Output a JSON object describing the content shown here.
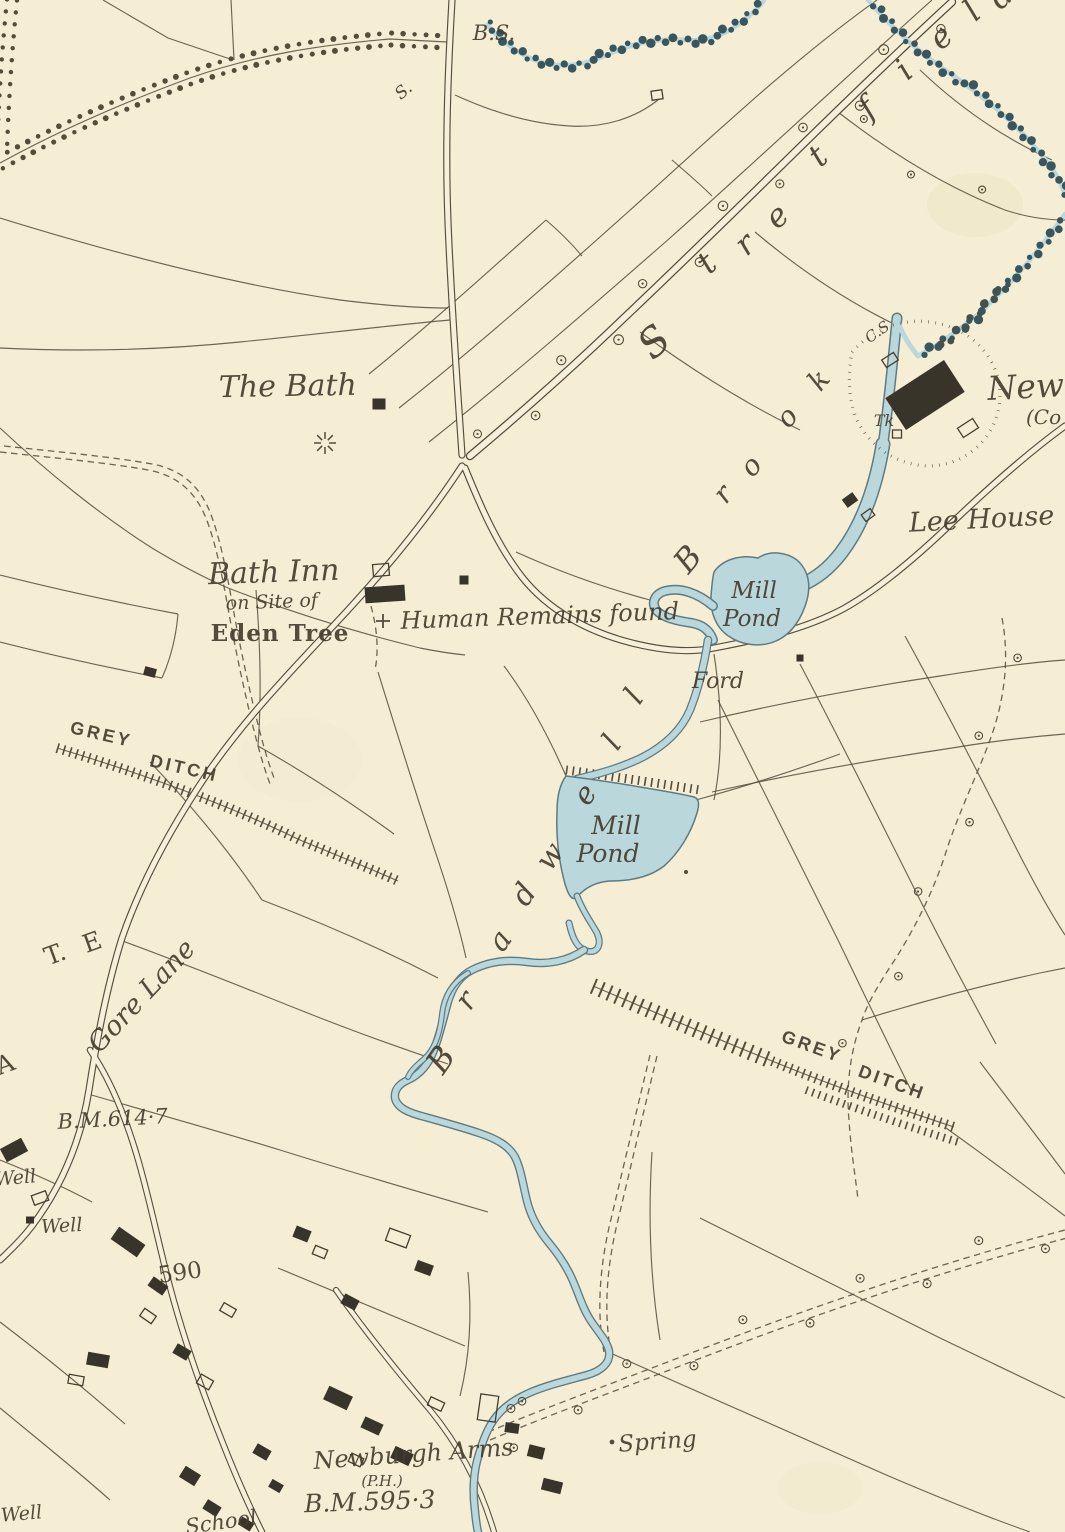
{
  "map_title": "Ordnance-Survey style historical map extract",
  "colors": {
    "paper": "#f6efd6",
    "ink": "#4b4435",
    "water_fill": "#b7d7de",
    "water_edge": "#547580",
    "woodland": "#2e4e59",
    "label_ink": "#3b3326"
  },
  "symbols": {
    "spring-rays": "radiating short strokes",
    "site-cross": "+",
    "spring-dot": "•"
  },
  "labels": [
    {
      "id": "bs",
      "text": "B.S.",
      "x": 494,
      "y": 40,
      "size": 21,
      "style": "italic"
    },
    {
      "id": "boundary-s",
      "text": "S.",
      "x": 407,
      "y": 95,
      "size": 17,
      "style": "italic",
      "rot": -40
    },
    {
      "id": "stret-1",
      "text": "S",
      "x": 663,
      "y": 352,
      "size": 40,
      "style": "italic",
      "rot": -42
    },
    {
      "id": "stret-2",
      "text": "t",
      "x": 714,
      "y": 271,
      "size": 32,
      "style": "italic",
      "rot": -42
    },
    {
      "id": "stret-3",
      "text": "r",
      "x": 752,
      "y": 252,
      "size": 32,
      "style": "italic",
      "rot": -42
    },
    {
      "id": "stret-4",
      "text": "e",
      "x": 784,
      "y": 224,
      "size": 32,
      "style": "italic",
      "rot": -42
    },
    {
      "id": "stret-5",
      "text": "t",
      "x": 825,
      "y": 164,
      "size": 32,
      "style": "italic",
      "rot": -42
    },
    {
      "id": "stret-6",
      "text": "f",
      "x": 874,
      "y": 116,
      "size": 32,
      "style": "italic",
      "rot": -42
    },
    {
      "id": "stret-7",
      "text": "i",
      "x": 911,
      "y": 78,
      "size": 32,
      "style": "italic",
      "rot": -42
    },
    {
      "id": "stret-8",
      "text": "e",
      "x": 948,
      "y": 45,
      "size": 32,
      "style": "italic",
      "rot": -42
    },
    {
      "id": "stret-9",
      "text": "l",
      "x": 979,
      "y": 19,
      "size": 32,
      "style": "italic",
      "rot": -42
    },
    {
      "id": "stret-10",
      "text": "d",
      "x": 1008,
      "y": 4,
      "size": 32,
      "style": "italic",
      "rot": -42
    },
    {
      "id": "the-bath",
      "text": "The Bath",
      "x": 288,
      "y": 396,
      "size": 30,
      "style": "italic",
      "rot": -1
    },
    {
      "id": "bath-inn",
      "text": "Bath Inn",
      "x": 274,
      "y": 582,
      "size": 30,
      "style": "italic",
      "rot": -2
    },
    {
      "id": "on-site-of",
      "text": "on Site of",
      "x": 272,
      "y": 608,
      "size": 19,
      "style": "italic",
      "rot": -2
    },
    {
      "id": "eden-tree",
      "text": "Eden Tree",
      "x": 280,
      "y": 641,
      "size": 23,
      "style": "blackletter"
    },
    {
      "id": "human-remains",
      "text": "Human Remains found",
      "x": 540,
      "y": 624,
      "size": 24,
      "style": "italic",
      "rot": -2
    },
    {
      "id": "mill-pond-1a",
      "text": "Mill",
      "x": 754,
      "y": 598,
      "size": 23,
      "style": "italic"
    },
    {
      "id": "mill-pond-1b",
      "text": "Pond",
      "x": 752,
      "y": 626,
      "size": 23,
      "style": "italic"
    },
    {
      "id": "ford",
      "text": "Ford",
      "x": 718,
      "y": 688,
      "size": 22,
      "style": "italic"
    },
    {
      "id": "tk",
      "text": "Tk",
      "x": 884,
      "y": 426,
      "size": 16,
      "style": "italic"
    },
    {
      "id": "cs",
      "text": "C.S",
      "x": 880,
      "y": 336,
      "size": 15,
      "style": "italic",
      "rot": -35
    },
    {
      "id": "new",
      "text": "New",
      "x": 988,
      "y": 400,
      "size": 33,
      "style": "italic",
      "anchor": "start",
      "rot": -3
    },
    {
      "id": "co",
      "text": "(Co",
      "x": 1026,
      "y": 424,
      "size": 20,
      "style": "italic",
      "anchor": "start"
    },
    {
      "id": "lee-house",
      "text": "Lee House",
      "x": 982,
      "y": 528,
      "size": 27,
      "style": "italic",
      "rot": -3
    },
    {
      "id": "brook-1",
      "text": "B",
      "x": 696,
      "y": 566,
      "size": 32,
      "style": "italic",
      "rot": -50
    },
    {
      "id": "brook-2",
      "text": "r",
      "x": 730,
      "y": 500,
      "size": 28,
      "style": "italic",
      "rot": -50
    },
    {
      "id": "brook-3",
      "text": "o",
      "x": 758,
      "y": 472,
      "size": 28,
      "style": "italic",
      "rot": -50
    },
    {
      "id": "brook-4",
      "text": "o",
      "x": 794,
      "y": 423,
      "size": 28,
      "style": "italic",
      "rot": -50
    },
    {
      "id": "brook-5",
      "text": "k",
      "x": 826,
      "y": 386,
      "size": 28,
      "style": "italic",
      "rot": -50
    },
    {
      "id": "mill-pond-2a",
      "text": "Mill",
      "x": 616,
      "y": 834,
      "size": 25,
      "style": "italic"
    },
    {
      "id": "mill-pond-2b",
      "text": "Pond",
      "x": 608,
      "y": 862,
      "size": 25,
      "style": "italic"
    },
    {
      "id": "brad-1",
      "text": "B",
      "x": 450,
      "y": 1066,
      "size": 33,
      "style": "italic",
      "rot": -55
    },
    {
      "id": "brad-2",
      "text": "r",
      "x": 474,
      "y": 1006,
      "size": 30,
      "style": "italic",
      "rot": -55
    },
    {
      "id": "brad-3",
      "text": "a",
      "x": 508,
      "y": 946,
      "size": 30,
      "style": "italic",
      "rot": -55
    },
    {
      "id": "brad-4",
      "text": "d",
      "x": 532,
      "y": 900,
      "size": 30,
      "style": "italic",
      "rot": -55
    },
    {
      "id": "brad-5",
      "text": "w",
      "x": 558,
      "y": 862,
      "size": 30,
      "style": "italic",
      "rot": -55
    },
    {
      "id": "brad-6",
      "text": "e",
      "x": 593,
      "y": 800,
      "size": 30,
      "style": "italic",
      "rot": -55
    },
    {
      "id": "brad-7",
      "text": "l",
      "x": 620,
      "y": 748,
      "size": 30,
      "style": "italic",
      "rot": -55
    },
    {
      "id": "brad-8",
      "text": "l",
      "x": 642,
      "y": 702,
      "size": 30,
      "style": "italic",
      "rot": -55
    },
    {
      "id": "grey-ditch-1a",
      "text": "GREY",
      "x": 100,
      "y": 740,
      "size": 18,
      "style": "caps",
      "rot": 13
    },
    {
      "id": "grey-ditch-1b",
      "text": "DITCH",
      "x": 183,
      "y": 774,
      "size": 18,
      "style": "caps",
      "rot": 13
    },
    {
      "id": "grey-ditch-2a",
      "text": "GREY",
      "x": 810,
      "y": 1052,
      "size": 18,
      "style": "caps",
      "rot": 20
    },
    {
      "id": "grey-ditch-2b",
      "text": "DITCH",
      "x": 890,
      "y": 1088,
      "size": 18,
      "style": "caps",
      "rot": 20
    },
    {
      "id": "gore-lane",
      "text": "Gore Lane",
      "x": 148,
      "y": 1002,
      "size": 27,
      "style": "italic",
      "rot": -47
    },
    {
      "id": "gate-a",
      "text": "A",
      "x": 8,
      "y": 1072,
      "size": 25,
      "style": "plain",
      "rot": -20
    },
    {
      "id": "gate-t",
      "text": "T.",
      "x": 58,
      "y": 962,
      "size": 25,
      "style": "plain",
      "rot": -20
    },
    {
      "id": "gate-e",
      "text": "E",
      "x": 95,
      "y": 950,
      "size": 25,
      "style": "plain",
      "rot": -20
    },
    {
      "id": "bm-614",
      "text": "B.M.614·7",
      "x": 113,
      "y": 1126,
      "size": 21,
      "style": "italic",
      "rot": -3
    },
    {
      "id": "well-1",
      "text": "Well",
      "x": 16,
      "y": 1184,
      "size": 19,
      "style": "italic",
      "rot": -5
    },
    {
      "id": "well-2",
      "text": "Well",
      "x": 62,
      "y": 1232,
      "size": 19,
      "style": "italic",
      "rot": -3
    },
    {
      "id": "spot-590",
      "text": "590",
      "x": 181,
      "y": 1280,
      "size": 23,
      "style": "plain",
      "rot": -8
    },
    {
      "id": "newburgh-arms",
      "text": "Newburgh Arms",
      "x": 414,
      "y": 1462,
      "size": 24,
      "style": "italic",
      "rot": -4
    },
    {
      "id": "ph",
      "text": "(P.H.)",
      "x": 382,
      "y": 1486,
      "size": 15,
      "style": "italic"
    },
    {
      "id": "bm-595",
      "text": "B.M.595·3",
      "x": 370,
      "y": 1510,
      "size": 25,
      "style": "italic",
      "rot": -2
    },
    {
      "id": "school",
      "text": "School",
      "x": 222,
      "y": 1529,
      "size": 21,
      "style": "italic",
      "rot": -8
    },
    {
      "id": "spring",
      "text": "Spring",
      "x": 658,
      "y": 1449,
      "size": 23,
      "style": "italic",
      "rot": -4
    },
    {
      "id": "well-3",
      "text": "Well",
      "x": 22,
      "y": 1520,
      "size": 19,
      "style": "italic",
      "rot": -5
    }
  ]
}
